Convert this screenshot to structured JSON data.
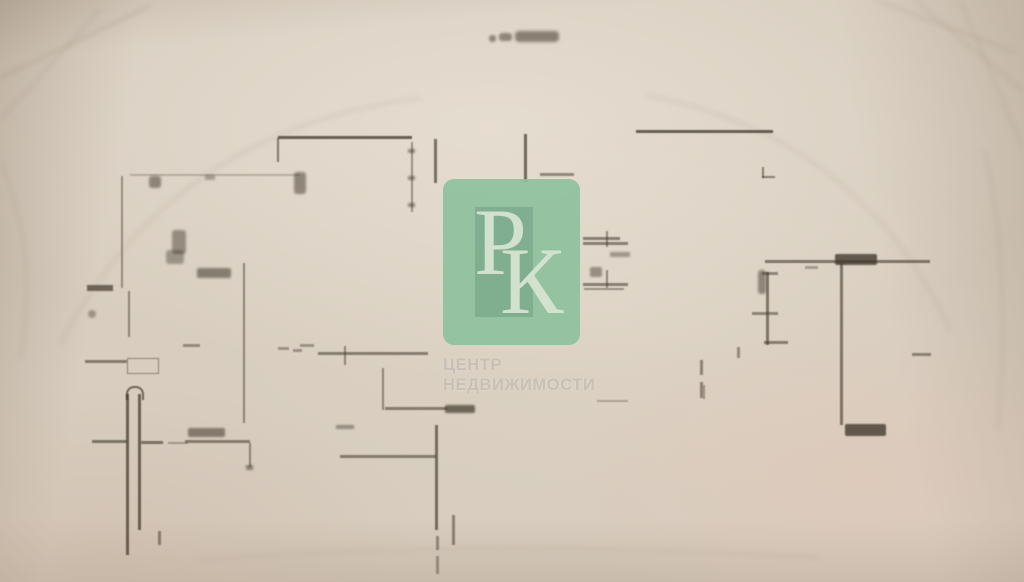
{
  "photo": {
    "paper_color": "#d8cdbf",
    "line_color": "#40372c",
    "crease_color": "#6e5c49",
    "creases": [
      {
        "d": "M0,78 L150,6",
        "o": 0.1
      },
      {
        "d": "M0,120 L100,10",
        "o": 0.07
      },
      {
        "d": "M875,0 L1015,52",
        "o": 0.08
      },
      {
        "d": "M915,0 L1024,92",
        "o": 0.07
      },
      {
        "d": "M960,0 L1024,150",
        "o": 0.06
      },
      {
        "d": "M60,345 Q170,130 420,98",
        "o": 0.08
      },
      {
        "d": "M645,95 Q860,135 950,330",
        "o": 0.07
      },
      {
        "d": "M985,150 Q1012,280 998,430",
        "o": 0.06
      },
      {
        "d": "M0,160 Q40,250 20,360",
        "o": 0.06
      },
      {
        "d": "M200,560 Q500,538 820,558",
        "o": 0.05
      }
    ]
  },
  "plan": {
    "segments": [
      {
        "n": "title-smudge",
        "x": 489,
        "y": 35,
        "w": 7,
        "h": 7,
        "op": 0.5,
        "blur": 1.4,
        "rad": 3
      },
      {
        "n": "title-smudge",
        "x": 499,
        "y": 33,
        "w": 13,
        "h": 8,
        "op": 0.5,
        "blur": 1.4,
        "rad": 3
      },
      {
        "n": "title-smudge",
        "x": 515,
        "y": 31,
        "w": 44,
        "h": 11,
        "op": 0.55,
        "blur": 1.6,
        "rad": 4
      },
      {
        "n": "wall",
        "x": 278,
        "y": 136,
        "w": 134,
        "h": 3,
        "op": 0.75
      },
      {
        "n": "wall-tick",
        "x": 277,
        "y": 138,
        "w": 2,
        "h": 24,
        "op": 0.6
      },
      {
        "n": "dimension-line",
        "x": 411,
        "y": 142,
        "w": 1.5,
        "h": 70,
        "op": 0.45
      },
      {
        "n": "dimension-arrow",
        "x": 408,
        "y": 149,
        "w": 7,
        "h": 4,
        "op": 0.5,
        "blur": 1
      },
      {
        "n": "dimension-arrow",
        "x": 408,
        "y": 176,
        "w": 7,
        "h": 4,
        "op": 0.5,
        "blur": 1
      },
      {
        "n": "dimension-arrow",
        "x": 408,
        "y": 203,
        "w": 7,
        "h": 4,
        "op": 0.5,
        "blur": 1
      },
      {
        "n": "wall-tick",
        "x": 434,
        "y": 139,
        "w": 2.5,
        "h": 44,
        "op": 0.65
      },
      {
        "n": "wall-tick",
        "x": 524,
        "y": 134,
        "w": 2.5,
        "h": 48,
        "op": 0.7
      },
      {
        "n": "wall",
        "x": 540,
        "y": 173,
        "w": 34,
        "h": 2.5,
        "op": 0.5
      },
      {
        "n": "wall",
        "x": 636,
        "y": 130,
        "w": 137,
        "h": 3,
        "op": 0.75
      },
      {
        "n": "wall-corner",
        "x": 762,
        "y": 167,
        "w": 2,
        "h": 11,
        "op": 0.55
      },
      {
        "n": "wall-corner",
        "x": 762,
        "y": 176,
        "w": 13,
        "h": 2,
        "op": 0.55
      },
      {
        "n": "wall",
        "x": 121,
        "y": 176,
        "w": 2,
        "h": 112,
        "op": 0.45
      },
      {
        "n": "wall",
        "x": 130,
        "y": 174,
        "w": 170,
        "h": 2,
        "op": 0.25
      },
      {
        "n": "mark-smudge",
        "x": 149,
        "y": 176,
        "w": 12,
        "h": 12,
        "op": 0.5,
        "blur": 1.2,
        "rad": 3
      },
      {
        "n": "mark-smudge",
        "x": 205,
        "y": 175,
        "w": 10,
        "h": 5,
        "op": 0.35,
        "blur": 1
      },
      {
        "n": "mark-smudge",
        "x": 294,
        "y": 172,
        "w": 12,
        "h": 22,
        "op": 0.5,
        "blur": 1.2,
        "rad": 3
      },
      {
        "n": "mark-smudge",
        "x": 172,
        "y": 230,
        "w": 14,
        "h": 24,
        "op": 0.45,
        "blur": 1.2,
        "rad": 3
      },
      {
        "n": "mark-smudge",
        "x": 166,
        "y": 250,
        "w": 18,
        "h": 14,
        "op": 0.4,
        "blur": 1.2,
        "rad": 3
      },
      {
        "n": "label-smudge",
        "x": 197,
        "y": 268,
        "w": 34,
        "h": 10,
        "op": 0.55,
        "blur": 1.2,
        "rad": 2
      },
      {
        "n": "wall-thick",
        "x": 87,
        "y": 285,
        "w": 26,
        "h": 6,
        "op": 0.7,
        "blur": 0.8
      },
      {
        "n": "wall",
        "x": 128,
        "y": 291,
        "w": 2,
        "h": 46,
        "op": 0.5
      },
      {
        "n": "mark-smudge",
        "x": 88,
        "y": 310,
        "w": 8,
        "h": 8,
        "op": 0.4,
        "blur": 1.2,
        "rad": 4
      },
      {
        "n": "wall",
        "x": 243,
        "y": 263,
        "w": 2,
        "h": 160,
        "op": 0.5
      },
      {
        "n": "wall",
        "x": 85,
        "y": 360,
        "w": 42,
        "h": 2.5,
        "op": 0.55
      },
      {
        "n": "fixture-rect",
        "type": "rect",
        "x": 127,
        "y": 358,
        "w": 30,
        "h": 14,
        "op": 0.5
      },
      {
        "n": "wall",
        "x": 183,
        "y": 344,
        "w": 17,
        "h": 2.5,
        "op": 0.45
      },
      {
        "n": "wall",
        "x": 278,
        "y": 347,
        "w": 11,
        "h": 2.5,
        "op": 0.4
      },
      {
        "n": "wall",
        "x": 293,
        "y": 349,
        "w": 9,
        "h": 2.5,
        "op": 0.4
      },
      {
        "n": "column-arc",
        "type": "arc",
        "x": 126,
        "y": 386,
        "w": 14,
        "h": 12,
        "op": 0.7
      },
      {
        "n": "column-wall",
        "x": 126,
        "y": 394,
        "w": 2.5,
        "h": 161,
        "op": 0.72
      },
      {
        "n": "column-wall",
        "x": 138,
        "y": 394,
        "w": 2.5,
        "h": 136,
        "op": 0.72
      },
      {
        "n": "wall",
        "x": 92,
        "y": 440,
        "w": 35,
        "h": 2.5,
        "op": 0.6
      },
      {
        "n": "wall",
        "x": 141,
        "y": 441,
        "w": 22,
        "h": 2.5,
        "op": 0.6
      },
      {
        "n": "wall",
        "x": 168,
        "y": 442,
        "w": 20,
        "h": 2,
        "op": 0.35
      },
      {
        "n": "wall-tick",
        "x": 158,
        "y": 531,
        "w": 3,
        "h": 14,
        "op": 0.5
      },
      {
        "n": "label-smudge",
        "x": 188,
        "y": 428,
        "w": 37,
        "h": 9,
        "op": 0.55,
        "blur": 1.1,
        "rad": 2
      },
      {
        "n": "wall",
        "x": 185,
        "y": 440,
        "w": 65,
        "h": 2.5,
        "op": 0.55
      },
      {
        "n": "wall-tick",
        "x": 249,
        "y": 443,
        "w": 2,
        "h": 24,
        "op": 0.5
      },
      {
        "n": "dimension-arrow",
        "x": 246,
        "y": 465,
        "w": 7,
        "h": 5,
        "op": 0.5,
        "blur": 1
      },
      {
        "n": "wall",
        "x": 318,
        "y": 352,
        "w": 110,
        "h": 2.5,
        "op": 0.55
      },
      {
        "n": "wall-tick",
        "x": 344,
        "y": 346,
        "w": 2,
        "h": 19,
        "op": 0.5
      },
      {
        "n": "wall",
        "x": 300,
        "y": 344,
        "w": 14,
        "h": 3,
        "op": 0.4
      },
      {
        "n": "wall",
        "x": 382,
        "y": 368,
        "w": 2,
        "h": 42,
        "op": 0.5
      },
      {
        "n": "wall",
        "x": 385,
        "y": 407,
        "w": 62,
        "h": 3,
        "op": 0.55
      },
      {
        "n": "label-smudge",
        "x": 445,
        "y": 405,
        "w": 30,
        "h": 8,
        "op": 0.7,
        "blur": 1,
        "rad": 2
      },
      {
        "n": "wall",
        "x": 435,
        "y": 425,
        "w": 2.5,
        "h": 105,
        "op": 0.65
      },
      {
        "n": "wall",
        "x": 436,
        "y": 536,
        "w": 2.5,
        "h": 14,
        "op": 0.45
      },
      {
        "n": "wall",
        "x": 436,
        "y": 556,
        "w": 2.5,
        "h": 18,
        "op": 0.4
      },
      {
        "n": "wall",
        "x": 340,
        "y": 455,
        "w": 96,
        "h": 2.5,
        "op": 0.55
      },
      {
        "n": "mark-smudge",
        "x": 336,
        "y": 425,
        "w": 18,
        "h": 4,
        "op": 0.45,
        "blur": 1
      },
      {
        "n": "wall-tick",
        "x": 452,
        "y": 515,
        "w": 2.5,
        "h": 30,
        "op": 0.5
      },
      {
        "n": "door-line",
        "x": 583,
        "y": 237,
        "w": 37,
        "h": 2.5,
        "op": 0.55
      },
      {
        "n": "door-line",
        "x": 583,
        "y": 242,
        "w": 45,
        "h": 2.5,
        "op": 0.55
      },
      {
        "n": "wall-tick",
        "x": 606,
        "y": 231,
        "w": 2,
        "h": 16,
        "op": 0.5
      },
      {
        "n": "mark-smudge",
        "x": 590,
        "y": 267,
        "w": 12,
        "h": 10,
        "op": 0.45,
        "blur": 1.1,
        "rad": 2
      },
      {
        "n": "door-line",
        "x": 583,
        "y": 283,
        "w": 45,
        "h": 2.5,
        "op": 0.55
      },
      {
        "n": "door-line",
        "x": 584,
        "y": 288,
        "w": 40,
        "h": 2,
        "op": 0.45
      },
      {
        "n": "wall-tick",
        "x": 606,
        "y": 270,
        "w": 2,
        "h": 18,
        "op": 0.5
      },
      {
        "n": "mark-smudge",
        "x": 610,
        "y": 252,
        "w": 20,
        "h": 5,
        "op": 0.4,
        "blur": 1
      },
      {
        "n": "wall",
        "x": 597,
        "y": 400,
        "w": 31,
        "h": 2,
        "op": 0.3
      },
      {
        "n": "wall-dash",
        "x": 700,
        "y": 360,
        "w": 2.5,
        "h": 15,
        "op": 0.5
      },
      {
        "n": "wall-dash",
        "x": 700,
        "y": 382,
        "w": 2.5,
        "h": 16,
        "op": 0.5
      },
      {
        "n": "wall",
        "x": 765,
        "y": 260,
        "w": 165,
        "h": 2.5,
        "op": 0.6
      },
      {
        "n": "label-smudge",
        "x": 835,
        "y": 254,
        "w": 42,
        "h": 11,
        "op": 0.78,
        "blur": 0.8,
        "rad": 2
      },
      {
        "n": "wall",
        "x": 840,
        "y": 263,
        "w": 2.5,
        "h": 162,
        "op": 0.6
      },
      {
        "n": "label-smudge",
        "x": 845,
        "y": 424,
        "w": 41,
        "h": 12,
        "op": 0.78,
        "blur": 0.8,
        "rad": 2
      },
      {
        "n": "wall",
        "x": 766,
        "y": 272,
        "w": 2.5,
        "h": 73,
        "op": 0.6
      },
      {
        "n": "mark-smudge",
        "x": 758,
        "y": 270,
        "w": 8,
        "h": 24,
        "op": 0.5,
        "blur": 1.2,
        "rad": 3
      },
      {
        "n": "wall",
        "x": 762,
        "y": 272,
        "w": 16,
        "h": 2.5,
        "op": 0.5
      },
      {
        "n": "wall",
        "x": 752,
        "y": 312,
        "w": 26,
        "h": 2.5,
        "op": 0.5
      },
      {
        "n": "wall",
        "x": 764,
        "y": 341,
        "w": 24,
        "h": 3,
        "op": 0.55
      },
      {
        "n": "wall",
        "x": 805,
        "y": 266,
        "w": 13,
        "h": 3,
        "op": 0.35
      },
      {
        "n": "wall",
        "x": 912,
        "y": 353,
        "w": 19,
        "h": 2.5,
        "op": 0.5
      },
      {
        "n": "wall-tick",
        "x": 737,
        "y": 347,
        "w": 3,
        "h": 11,
        "op": 0.45
      },
      {
        "n": "wall-tick",
        "x": 703,
        "y": 385,
        "w": 2,
        "h": 14,
        "op": 0.4
      }
    ]
  },
  "watermark": {
    "monogram_letter_1": "Р",
    "monogram_letter_2": "К",
    "caption_line1": "ЦЕНТР",
    "caption_line2": "НЕДВИЖИМОСТИ",
    "badge_color": "#8bc19d",
    "badge_inner_color": "#69a181",
    "monogram_color": "#d7e8d5",
    "caption_color": "#c9c0b5"
  }
}
